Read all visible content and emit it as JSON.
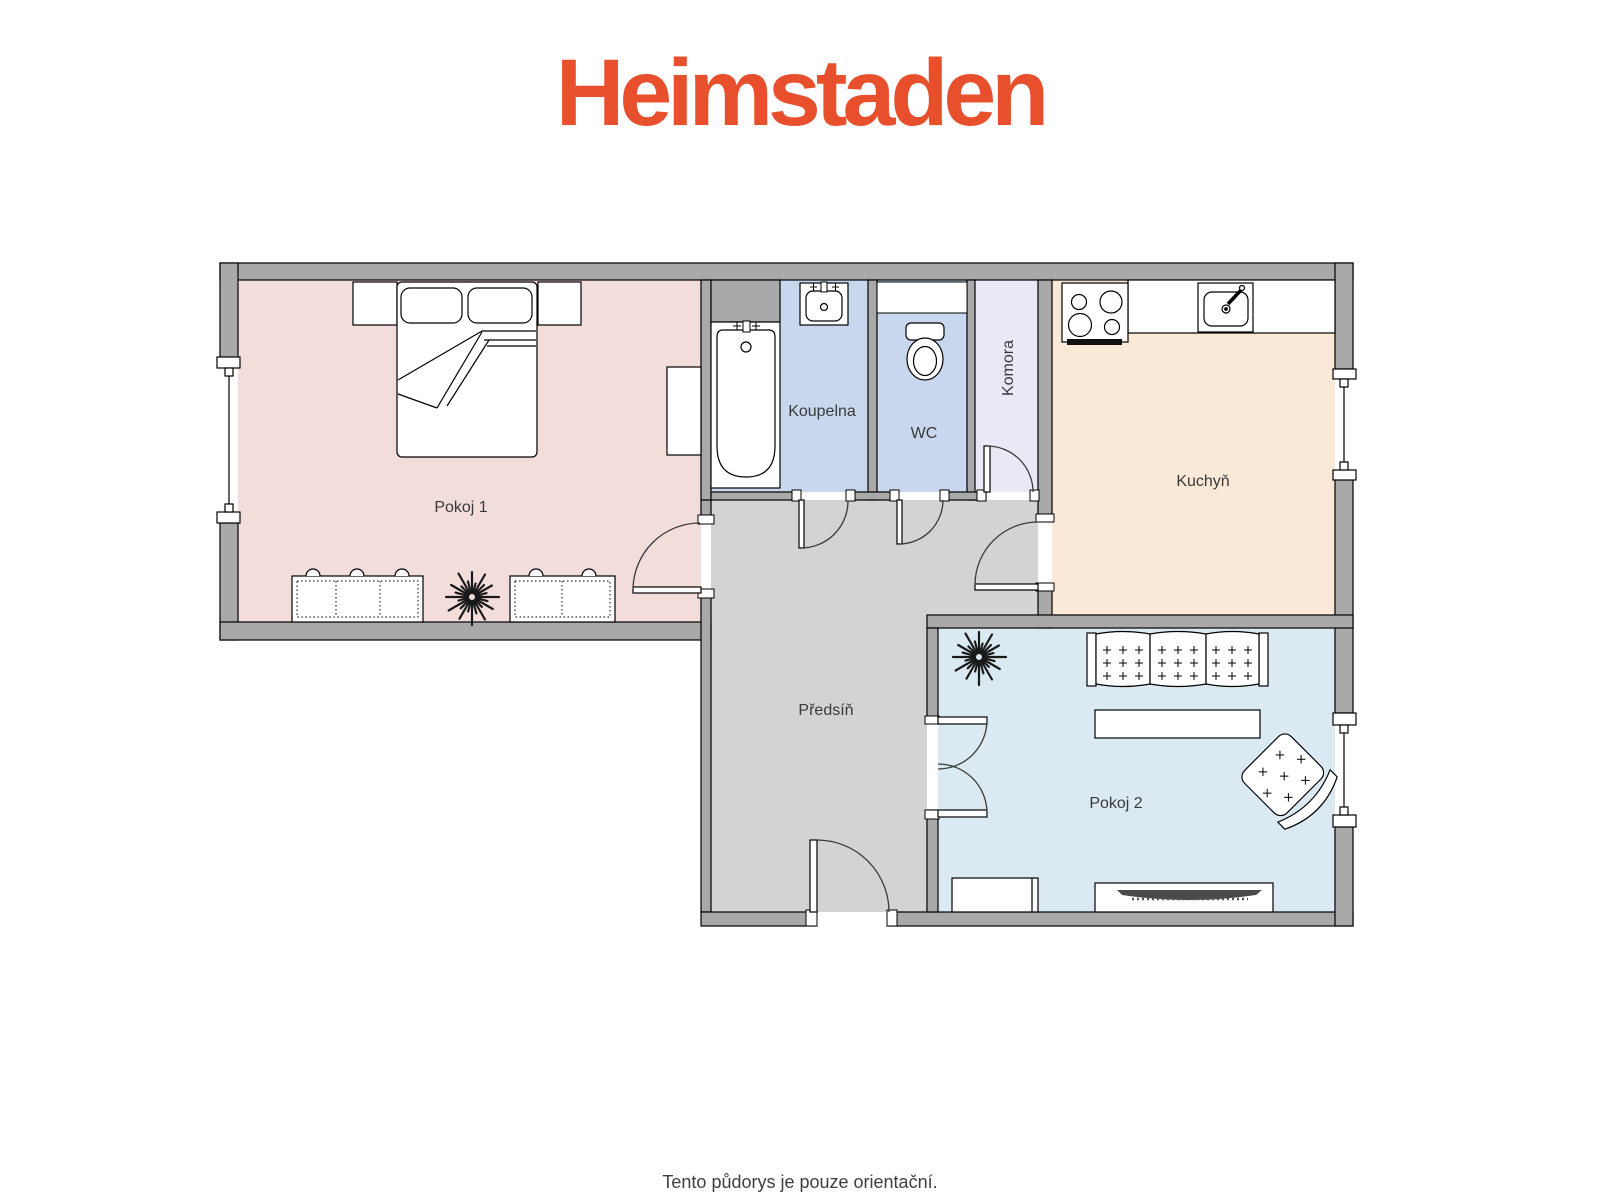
{
  "logo": {
    "text": "Heimstaden",
    "color": "#E8502D"
  },
  "walls": {
    "color": "#A9A9A9"
  },
  "rooms": {
    "pokoj1": {
      "label": "Pokoj 1",
      "floor_color": "#F2DDDB"
    },
    "koupelna": {
      "label": "Koupelna",
      "floor_color": "#C8D7ED"
    },
    "wc": {
      "label": "WC",
      "floor_color": "#C8D7ED"
    },
    "komora": {
      "label": "Komora",
      "floor_color": "#E9E8F4"
    },
    "kuchyn": {
      "label": "Kuchyň",
      "floor_color": "#FBE9D8"
    },
    "predsin": {
      "label": "Předsíň",
      "floor_color": "#D3D3D3"
    },
    "pokoj2": {
      "label": "Pokoj 2",
      "floor_color": "#DBEAF2"
    }
  },
  "footer": {
    "note": "Tento půdorys je pouze orientační."
  }
}
